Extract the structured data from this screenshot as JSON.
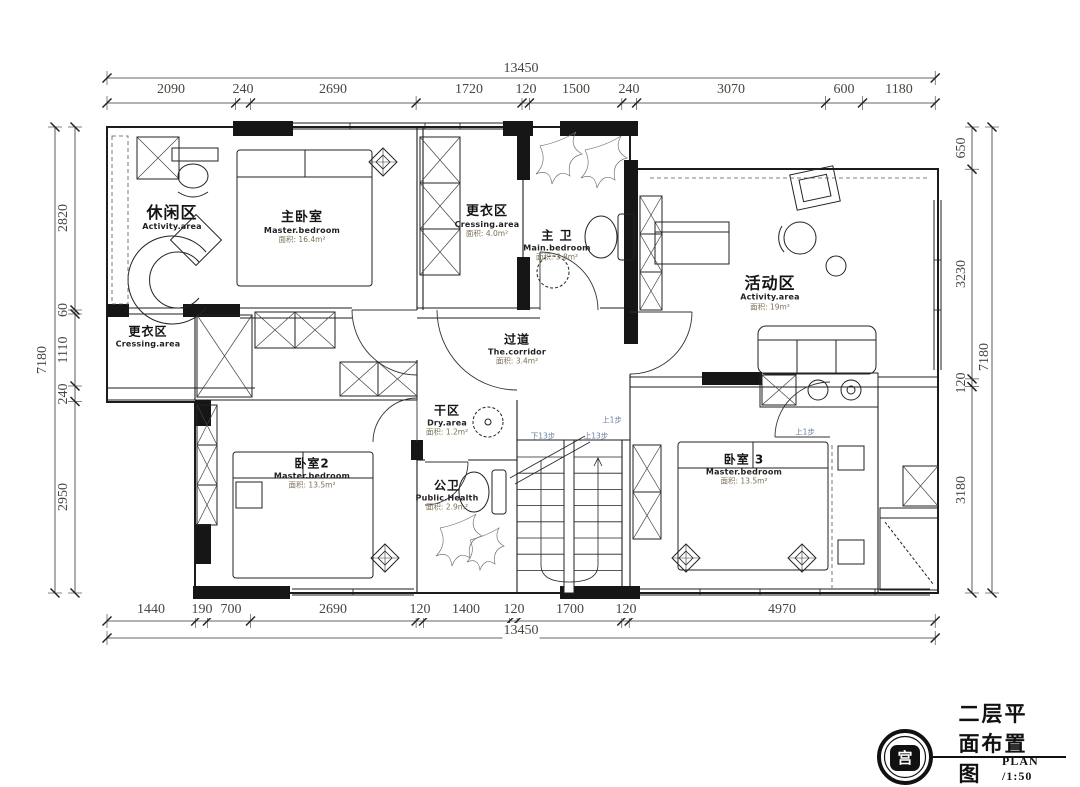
{
  "dims": {
    "top": {
      "overall": "13450",
      "segments": [
        "2090",
        "240",
        "2690",
        "1720",
        "120",
        "1500",
        "240",
        "3070",
        "600",
        "1180"
      ]
    },
    "bottom": {
      "overall": "13450",
      "segments": [
        "1440",
        "190",
        "700",
        "2690",
        "120",
        "1400",
        "120",
        "1700",
        "120",
        "4970"
      ]
    },
    "left": {
      "overall": "7180",
      "segments": [
        "2820",
        "60",
        "1110",
        "240",
        "2950"
      ]
    },
    "right": {
      "overall": "7180",
      "segments": [
        "650",
        "3230",
        "120",
        "3180"
      ]
    }
  },
  "rooms": {
    "lounge": {
      "zh": "休闲区",
      "en": "Activity.area"
    },
    "master_bedroom": {
      "zh": "主卧室",
      "en": "Master.bedroom",
      "area": "面积: 16.4m²"
    },
    "dressing_top": {
      "zh": "更衣区",
      "en": "Cressing.area",
      "area": "面积: 4.0m²"
    },
    "master_bath": {
      "zh": "主 卫",
      "en": "Main.bedroom",
      "area": "面积: 3.8m²"
    },
    "activity": {
      "zh": "活动区",
      "en": "Activity.area",
      "area": "面积: 19m²"
    },
    "dressing_left": {
      "zh": "更衣区",
      "en": "Cressing.area"
    },
    "corridor": {
      "zh": "过道",
      "en": "The.corridor",
      "area": "面积: 3.4m²"
    },
    "dry_area": {
      "zh": "干区",
      "en": "Dry.area",
      "area": "面积: 1.2m²"
    },
    "bedroom2": {
      "zh": "卧室2",
      "en": "Master.bedroom",
      "area": "面积: 13.5m²"
    },
    "public_bath": {
      "zh": "公卫",
      "en": "Public.Health",
      "area": "面积: 2.9m²"
    },
    "bedroom3": {
      "zh": "卧室 3",
      "en": "Master.bedroom",
      "area": "面积: 13.5m²"
    }
  },
  "annotations": {
    "stair_down": "下13步",
    "stair_up": "上13步",
    "step1": "上1步",
    "step2": "上1步"
  },
  "title_block": {
    "title": "二层平面布置图",
    "plan_label": "PLAN  /1:50",
    "logo_glyph": "宫"
  },
  "colors": {
    "line": "#1c1c1c",
    "dim_text": "#4a4540",
    "area_text": "#7d7157",
    "note_text": "#6b7fa3"
  }
}
